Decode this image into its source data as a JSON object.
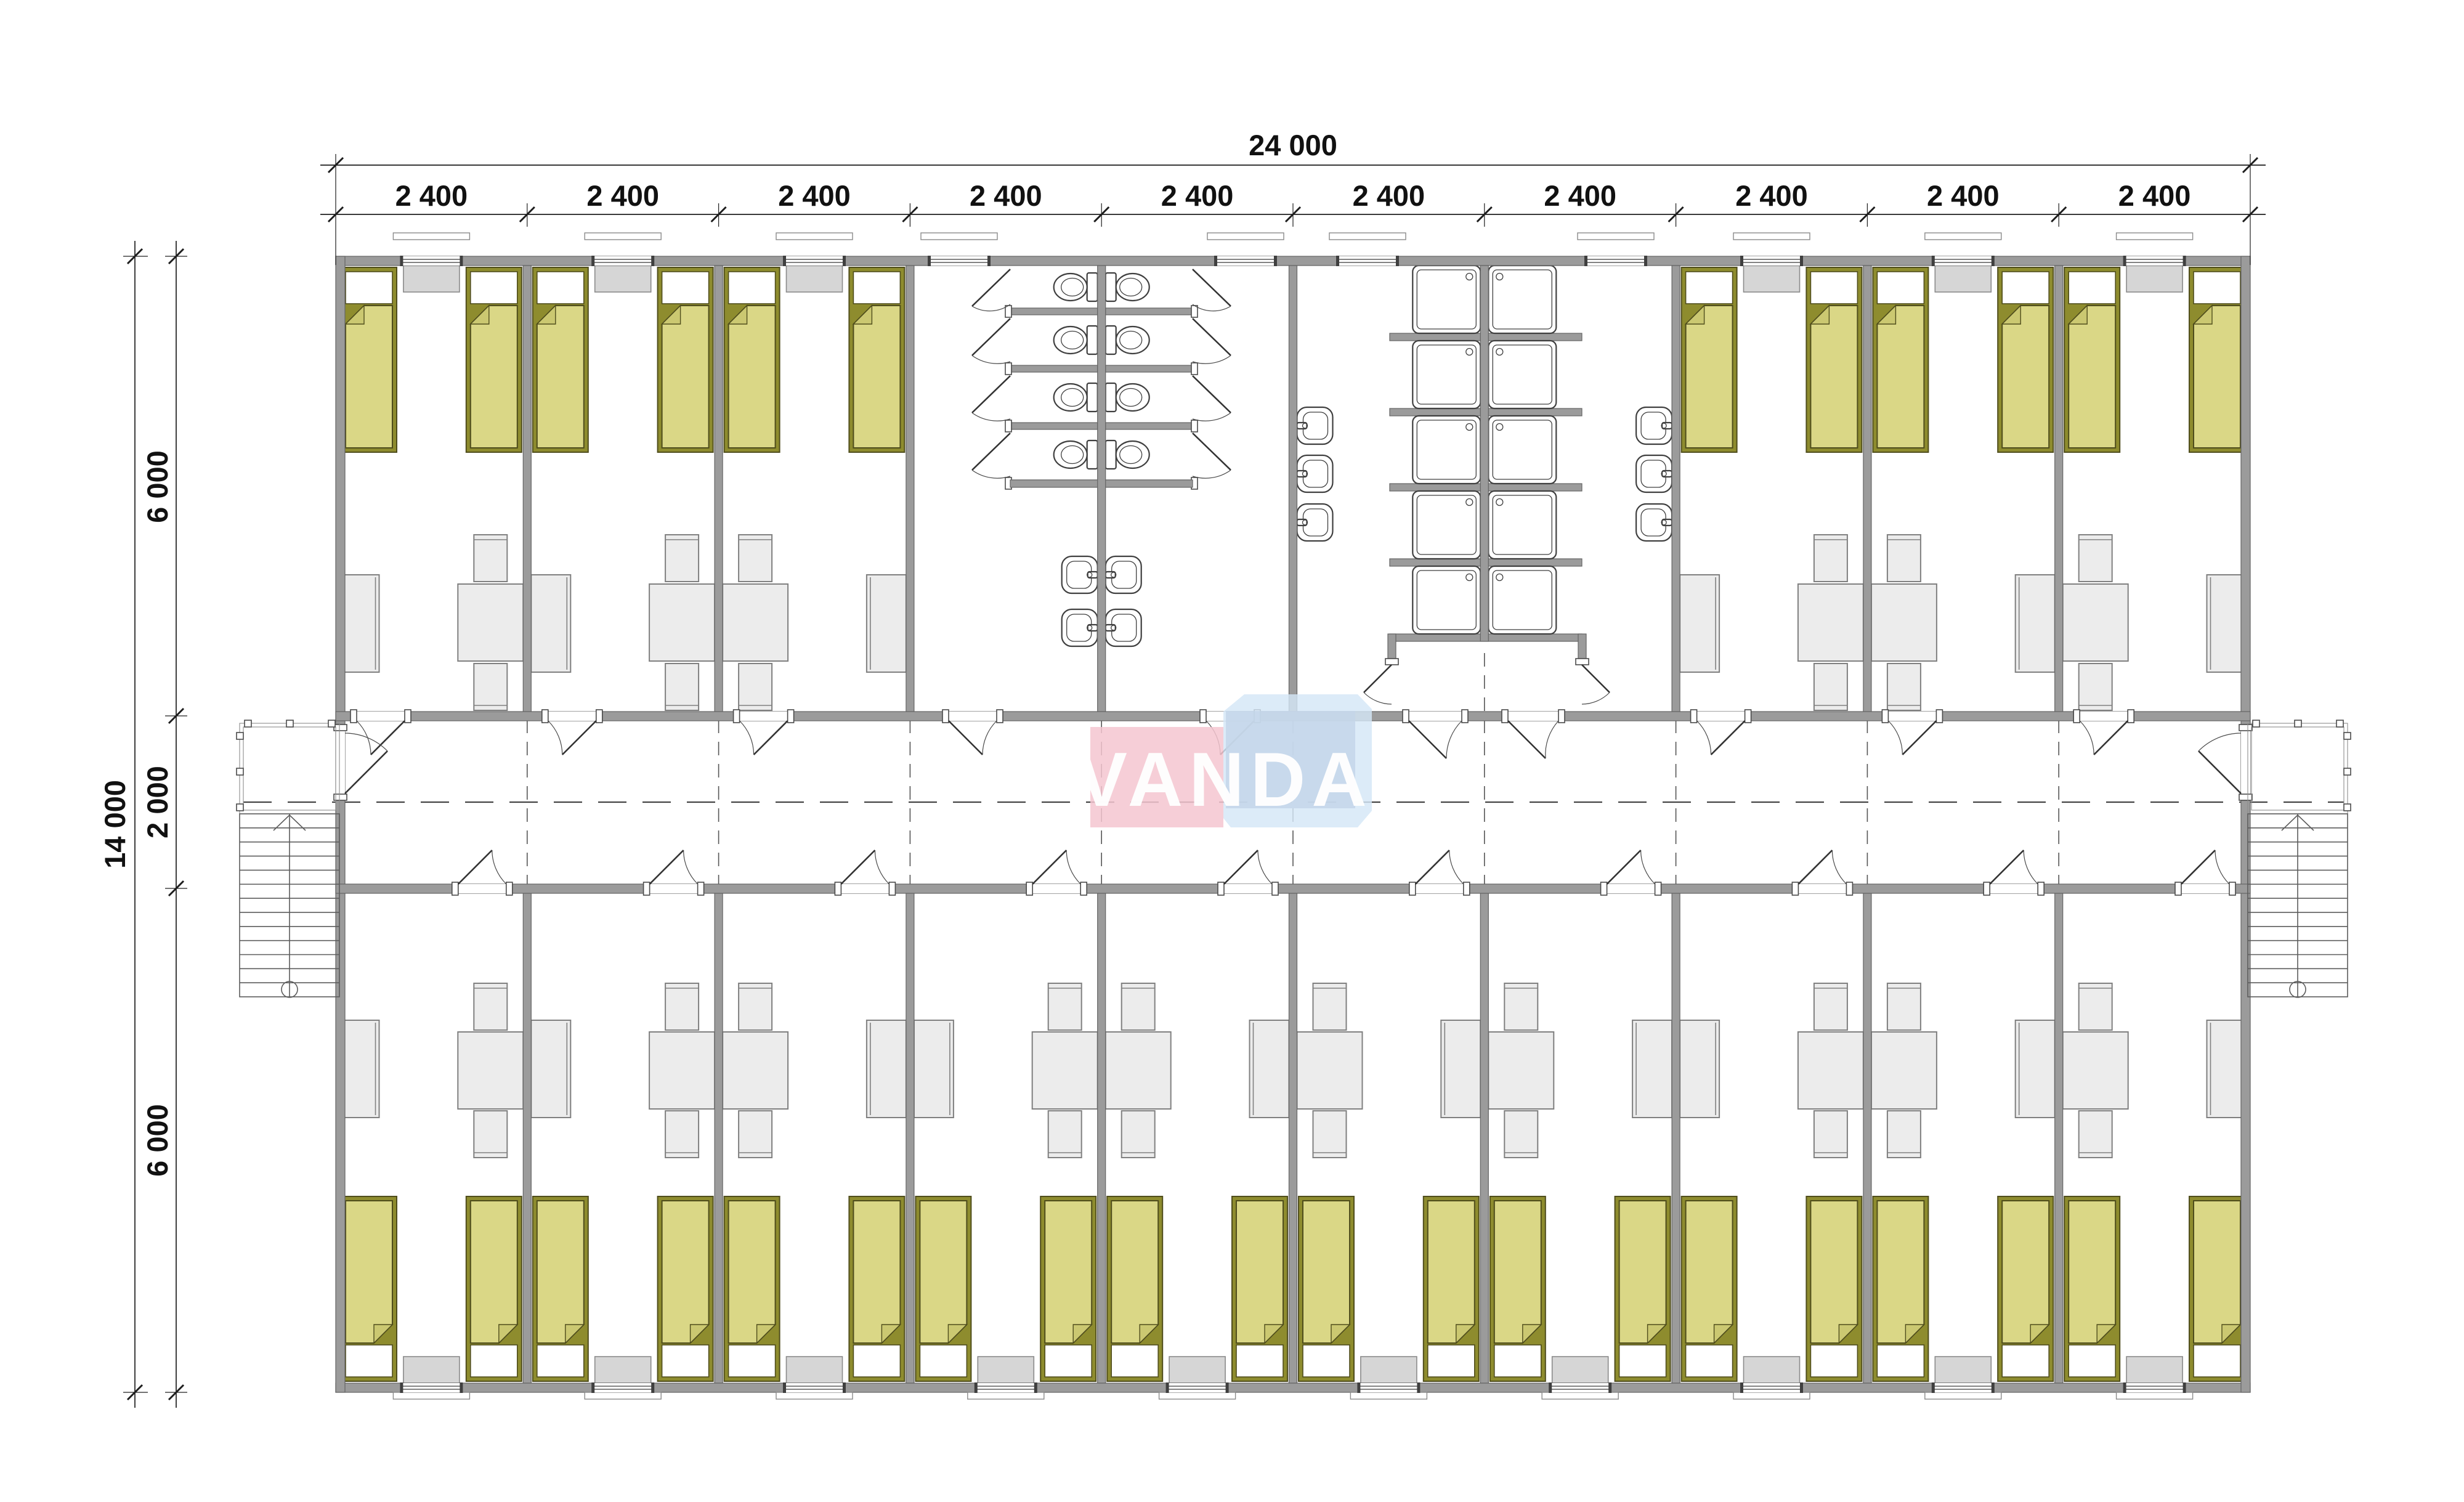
{
  "watermark": {
    "text": "VANDA",
    "pink": "#f5c6d0",
    "blue_light": "#d4e7f7",
    "blue_mid": "#c3d5e8",
    "text_color": "#ffffff"
  },
  "dimensions": {
    "total_width": "24 000",
    "modules": [
      "2 400",
      "2 400",
      "2 400",
      "2 400",
      "2 400",
      "2 400",
      "2 400",
      "2 400",
      "2 400",
      "2 400"
    ],
    "total_height": "14 000",
    "height_segments": [
      "6 000",
      "2 000",
      "6 000"
    ]
  },
  "colors": {
    "wall": "#9b9b9b",
    "bed_frame": "#8e8c2e",
    "bed_blanket": "#dad786",
    "furniture": "#ececec",
    "radiator": "#d6d6d6",
    "fixture_outline": "#3f3f3f",
    "dimension_text": "#111111"
  },
  "rooms": {
    "top": [
      {
        "module": 1,
        "table_side": "right"
      },
      {
        "module": 2,
        "table_side": "right"
      },
      {
        "module": 3,
        "table_side": "left"
      },
      {
        "module": 8,
        "table_side": "right"
      },
      {
        "module": 9,
        "table_side": "left"
      },
      {
        "module": 10,
        "table_side": "left"
      }
    ],
    "bottom": [
      {
        "module": 1,
        "table_side": "right"
      },
      {
        "module": 2,
        "table_side": "right"
      },
      {
        "module": 3,
        "table_side": "left"
      },
      {
        "module": 4,
        "table_side": "right"
      },
      {
        "module": 5,
        "table_side": "left"
      },
      {
        "module": 6,
        "table_side": "left"
      },
      {
        "module": 7,
        "table_side": "left"
      },
      {
        "module": 8,
        "table_side": "right"
      },
      {
        "module": 9,
        "table_side": "left"
      },
      {
        "module": 10,
        "table_side": "left"
      }
    ],
    "beds_per_room": 2
  },
  "sanitary": {
    "toilet_block": {
      "modules": [
        4,
        5
      ],
      "wc_stalls": 8,
      "sinks": 4
    },
    "shower_block": {
      "modules": [
        6,
        7
      ],
      "shower_trays": 10,
      "sinks": 6
    }
  },
  "stairs": {
    "count": 2,
    "location": "both ends of central corridor"
  }
}
